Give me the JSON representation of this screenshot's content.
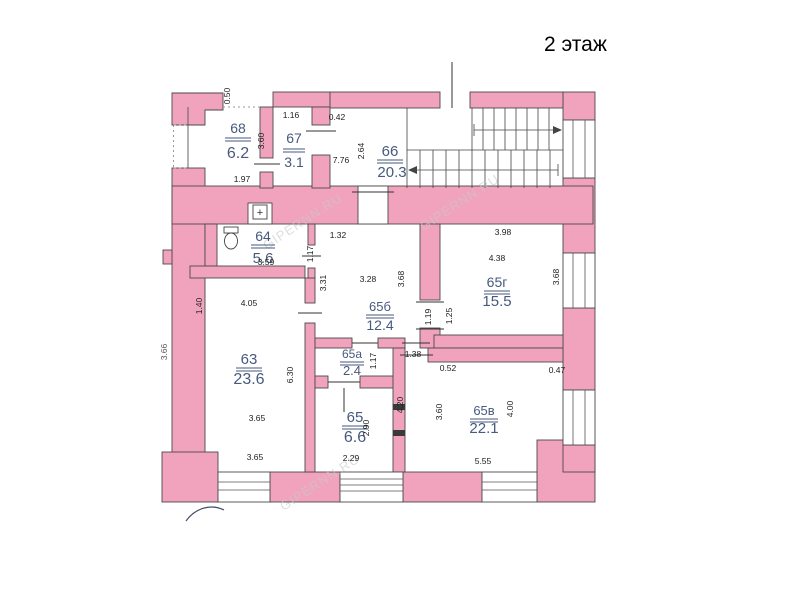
{
  "title": "2 этаж",
  "watermark": "GIPERNN.RU",
  "symbols": {
    "vent": "+"
  },
  "colors": {
    "wall": "#F1A3BE",
    "outline": "#4a4a4a",
    "label": "#47597d",
    "dim": "#1c1c1c"
  },
  "rooms": {
    "r68": {
      "number": "68",
      "area": "6.2"
    },
    "r67": {
      "number": "67",
      "area": "3.1"
    },
    "r66": {
      "number": "66",
      "area": "20.3"
    },
    "r64": {
      "number": "64",
      "area": "5.6"
    },
    "r63": {
      "number": "63",
      "area": "23.6"
    },
    "r65b": {
      "number": "65б",
      "area": "12.4"
    },
    "r65g": {
      "number": "65г",
      "area": "15.5"
    },
    "r65a": {
      "number": "65а",
      "area": "2.4"
    },
    "r65": {
      "number": "65",
      "area": "6.6"
    },
    "r65v": {
      "number": "65в",
      "area": "22.1"
    }
  },
  "dims": {
    "v050": "0.50",
    "r68w": "1.97",
    "r68h": "3.60",
    "r67w": "1.16",
    "r66a": "0.42",
    "r66w": "7.76",
    "r66h": "2.64",
    "r65g_w1": "3.98",
    "r65g_w2": "4.38",
    "r65g_h": "3.68",
    "r64_1": "1.32",
    "r64_d": "1.17",
    "r64w": "3.59",
    "r65b_hl": "3.31",
    "r65b_w": "3.28",
    "r65b_h": "3.68",
    "r65b_d1": "1.19",
    "r65b_d2": "1.25",
    "r63w": "4.05",
    "r63_l": "1.40",
    "r63h": "6.30",
    "r63_b1": "3.65",
    "r63_b2": "3.65",
    "r65a_h": "1.17",
    "r65a_d": "1.38",
    "r65v_s1": "0.52",
    "r65v_s2": "0.47",
    "r65v_hl": "3.60",
    "r65v_hr": "4.00",
    "r65v_w": "5.55",
    "r65_cor": "4.20",
    "r65_h": "2.90",
    "r65_w": "2.29",
    "outer_left": "3.66"
  }
}
